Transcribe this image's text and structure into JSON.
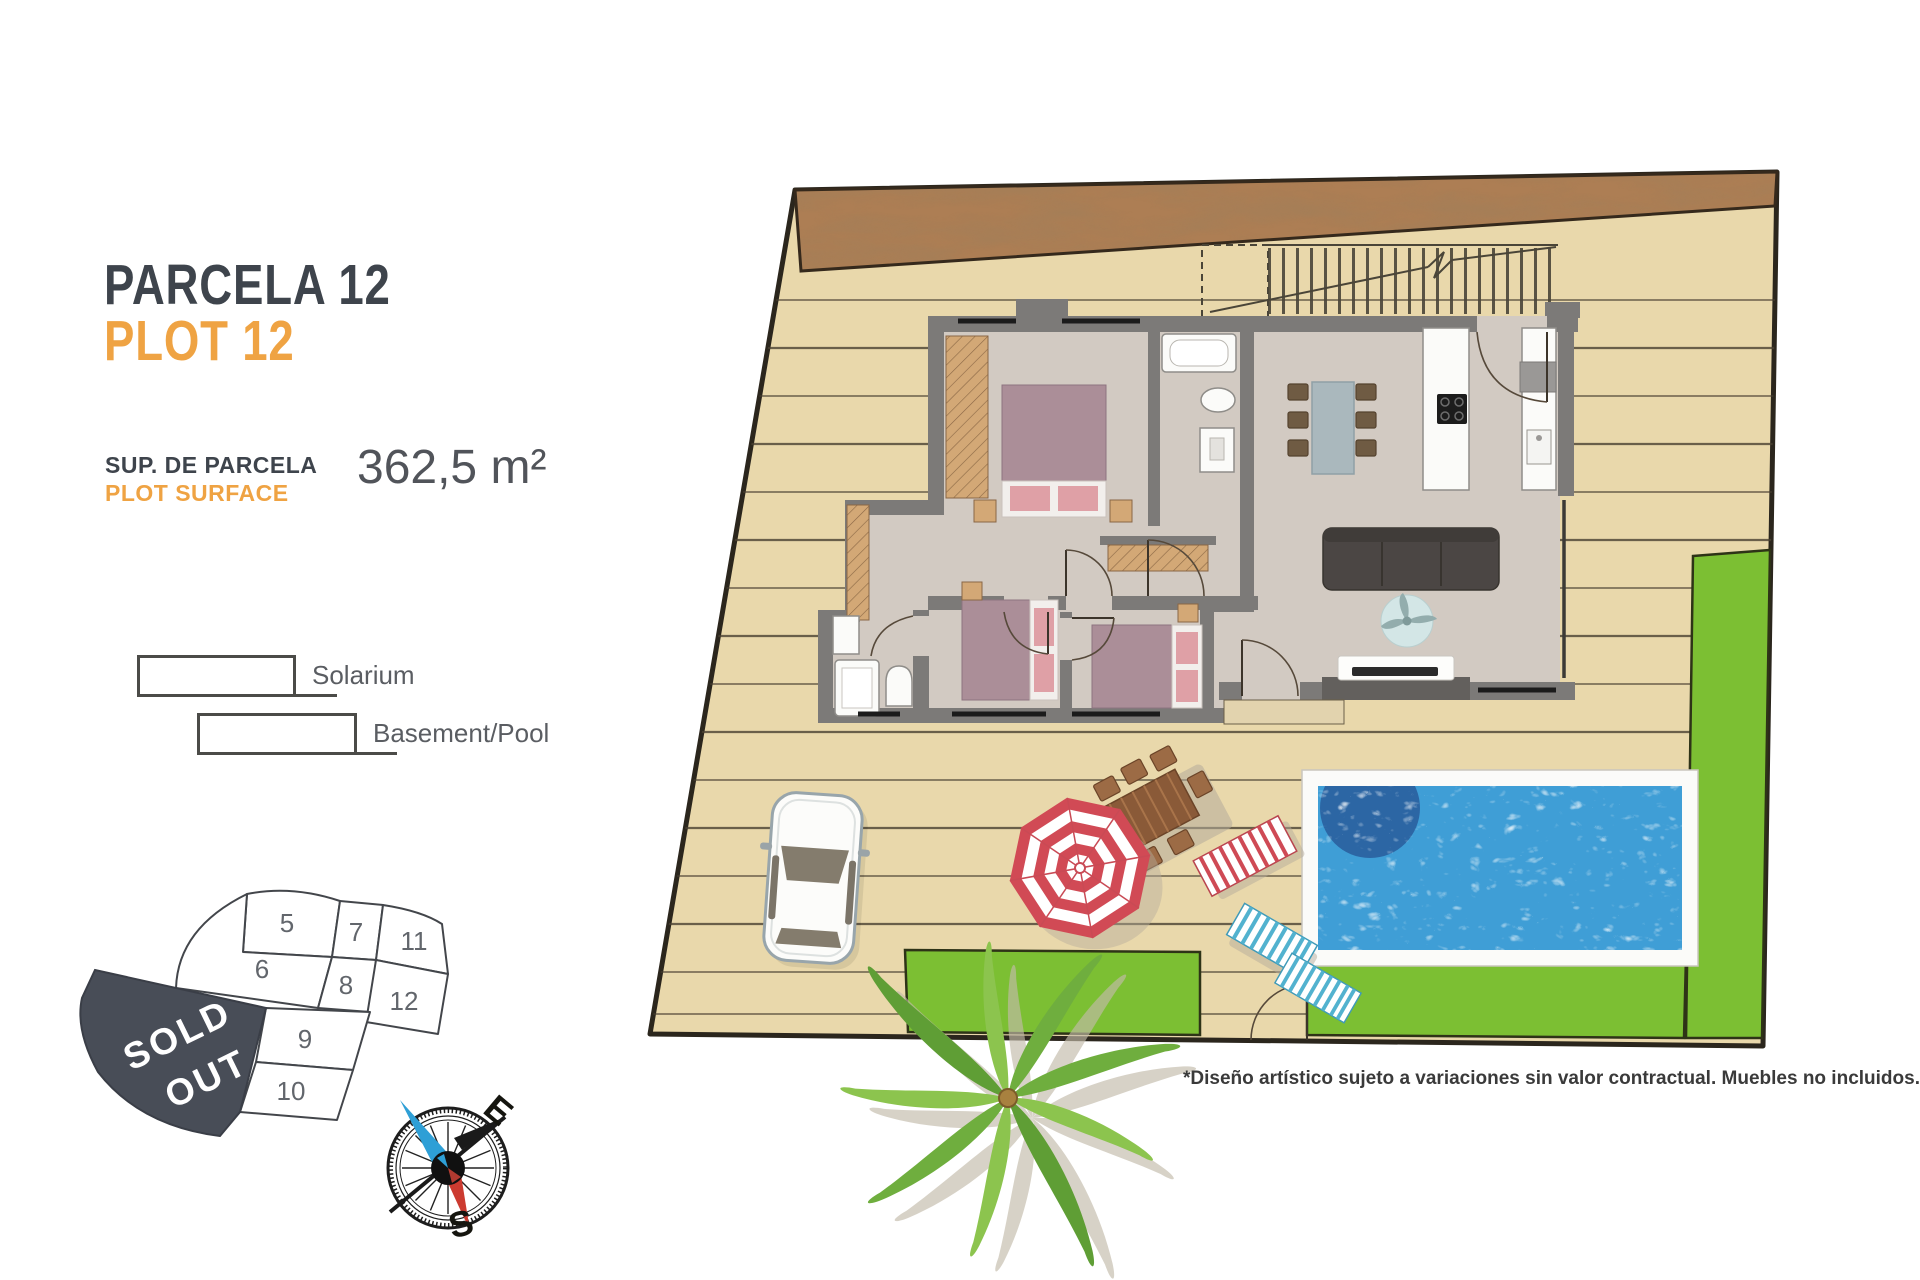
{
  "header": {
    "title_primary": "PARCELA 12",
    "title_secondary": "PLOT 12",
    "surface_label_primary": "SUP. DE PARCELA",
    "surface_label_secondary": "PLOT SURFACE",
    "surface_value": "362,5 m²"
  },
  "legend": {
    "items": [
      {
        "label": "Solarium"
      },
      {
        "label": "Basement/Pool"
      }
    ]
  },
  "site_map": {
    "sold_out_lines": [
      "SOLD",
      "OUT"
    ],
    "highlighted_plot": "12",
    "plots": [
      {
        "number": "5"
      },
      {
        "number": "6"
      },
      {
        "number": "7"
      },
      {
        "number": "8"
      },
      {
        "number": "9"
      },
      {
        "number": "10"
      },
      {
        "number": "11"
      },
      {
        "number": "12",
        "highlighted": true
      }
    ]
  },
  "compass": {
    "east_label": "E",
    "south_label": "S"
  },
  "disclaimer": {
    "text": "*Diseño artístico sujeto a variaciones sin valor contractual. Muebles no incluidos."
  },
  "colors": {
    "accent_orange": "#efa343",
    "title_gray": "#3e444c",
    "deck_tan": "#e9d8ab",
    "terrain_brown": "#ad7e54",
    "wall_gray": "#7c7a78",
    "floor_gray": "#d2cac2",
    "pool_blue": "#3f9ed6",
    "pool_deep_blue": "#2a5f9f",
    "grass_green": "#7cbf33",
    "sold_out_gray": "#484d57",
    "bed_mauve": "#ab8e98",
    "pillow_pink": "#dfa0a6",
    "wood_tan": "#d3a876"
  }
}
